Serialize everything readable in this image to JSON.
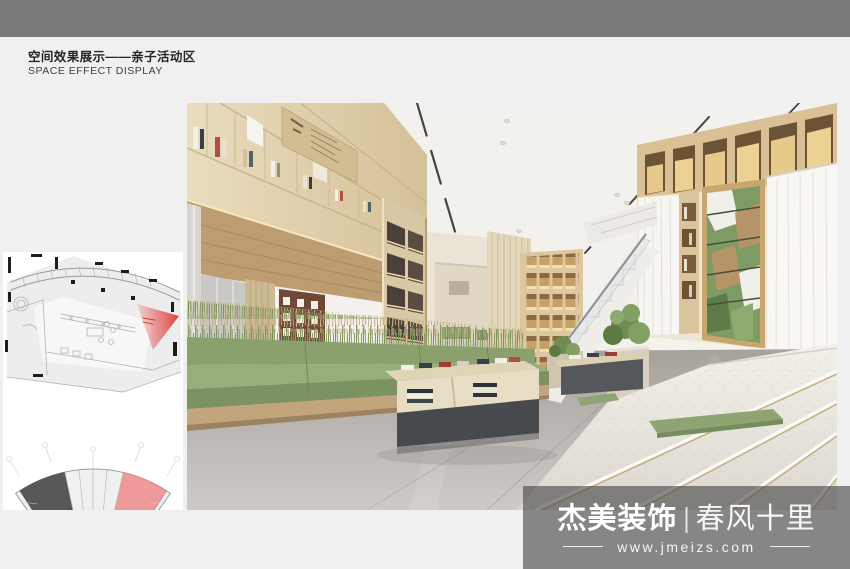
{
  "header": {
    "title_cn": "空间效果展示——亲子活动区",
    "title_en": "SPACE EFFECT DISPLAY"
  },
  "watermark": {
    "brand": "杰美装饰",
    "divider": "|",
    "slogan": "春风十里",
    "website": "www.jmeizs.com"
  },
  "colors": {
    "top_bar": "#797a7c",
    "page_background": "#f0f0f1",
    "plan_highlight_cone": "#e03c3c",
    "key_plan_highlight": "#ee9a9a",
    "wood": "#d9c7a3",
    "sage_green": "#8aa06d",
    "floor_gray": "#b1aba6",
    "terrazzo": "#ece9e2",
    "watermark_overlay": "rgba(70,70,70,0.62)"
  }
}
